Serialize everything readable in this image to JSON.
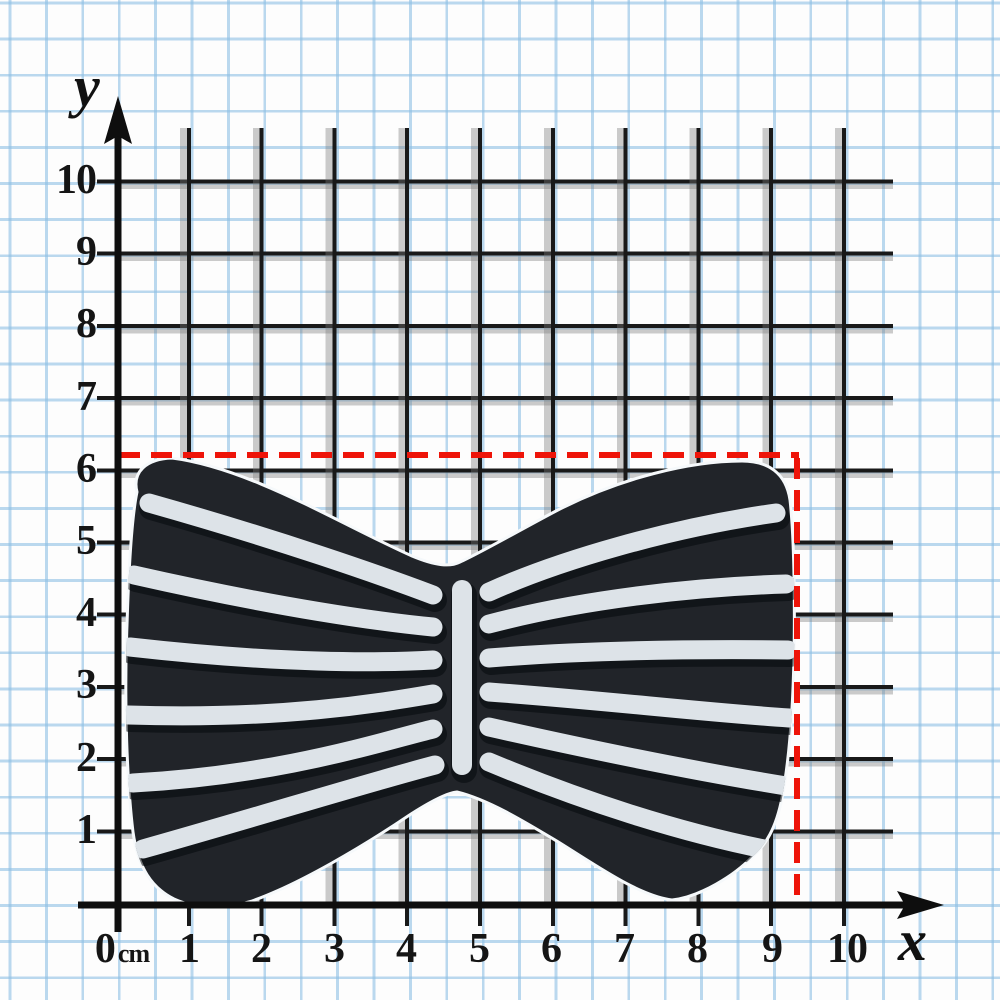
{
  "figure": {
    "description": "Photograph of a black silicone bow tie with white piping stripes laid on centimetre graph paper with x and y axes",
    "object_name": "striped bow tie",
    "indicated_width_cm": 9.4,
    "indicated_height_cm": 6.2
  },
  "axis": {
    "x_label": "x",
    "y_label": "y",
    "unit": "cm",
    "x_ticks": [
      "0",
      "1",
      "2",
      "3",
      "4",
      "5",
      "6",
      "7",
      "8",
      "9",
      "10"
    ],
    "y_ticks": [
      "1",
      "2",
      "3",
      "4",
      "5",
      "6",
      "7",
      "8",
      "9",
      "10"
    ]
  },
  "colors": {
    "measure_line_red": "#ee1409",
    "blue_grid": "#8dbfe4",
    "black_grid": "#191919",
    "bow_body": "#212429",
    "bow_stripe": "#dde3e8"
  }
}
